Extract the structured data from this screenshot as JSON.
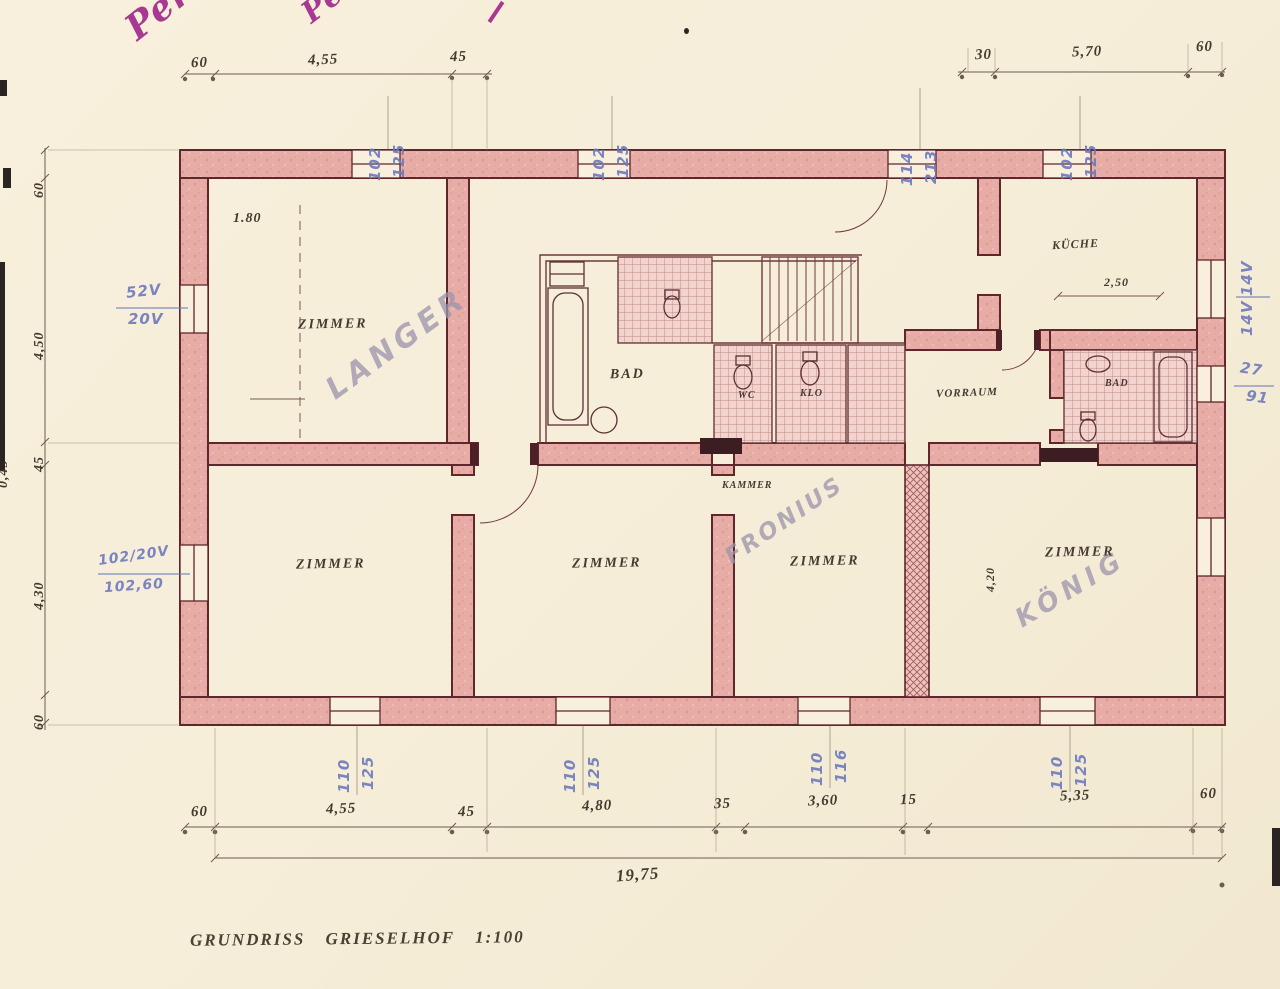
{
  "colors": {
    "paper": "#f6eedb",
    "wall_pink": "#e7aca6",
    "wall_line": "#5e272c",
    "ink": "#3e332d",
    "blue": "#6d79bd",
    "purple": "#a63a92",
    "pencil": "#9c93ad"
  },
  "handwriting": {
    "top_left": "Perneg",
    "top_mid": "Pe"
  },
  "pencil_names": {
    "langer": "LANGER",
    "fronius": "FRONIUS",
    "koenig": "KÖNIG"
  },
  "rooms": {
    "zimmer_top": "ZIMMER",
    "bad_main": "BAD",
    "wc": "WC",
    "klo": "KLO",
    "kueche": "KÜCHE",
    "vorraum": "VORRAUM",
    "bad_right": "BAD",
    "kammer": "KAMMER",
    "zimmer_b1": "ZIMMER",
    "zimmer_b2": "ZIMMER",
    "zimmer_b3": "ZIMMER",
    "zimmer_b4": "ZIMMER"
  },
  "annotations": {
    "door_height": "1.80",
    "kueche_width": "2,50",
    "zimmer4_depth": "4,20"
  },
  "dims": {
    "top": [
      "60",
      "4,55",
      "45",
      "30",
      "5,70",
      "60"
    ],
    "bottom": [
      "60",
      "4,55",
      "45",
      "4,80",
      "35",
      "3,60",
      "15",
      "5,35",
      "60"
    ],
    "total": "19,75",
    "left": [
      "60",
      "4,50",
      "45",
      "4,30",
      "60"
    ],
    "left_partial": "0,45",
    "blue_top": [
      [
        "102",
        "125"
      ],
      [
        "102",
        "125"
      ],
      [
        "114",
        "213"
      ],
      [
        "102",
        "125"
      ]
    ],
    "blue_bottom": [
      [
        "110",
        "125"
      ],
      [
        "110",
        "125"
      ],
      [
        "110",
        "116"
      ],
      [
        "110",
        "125"
      ]
    ],
    "blue_left": [
      "52V",
      "20V"
    ],
    "blue_left_mid": [
      "102/20V",
      "102,60"
    ],
    "blue_right_top": [
      "14V",
      "14V"
    ],
    "blue_right_mid": [
      "27",
      "91"
    ]
  },
  "caption": "GRUNDRISS GRIESELHOF 1:100"
}
